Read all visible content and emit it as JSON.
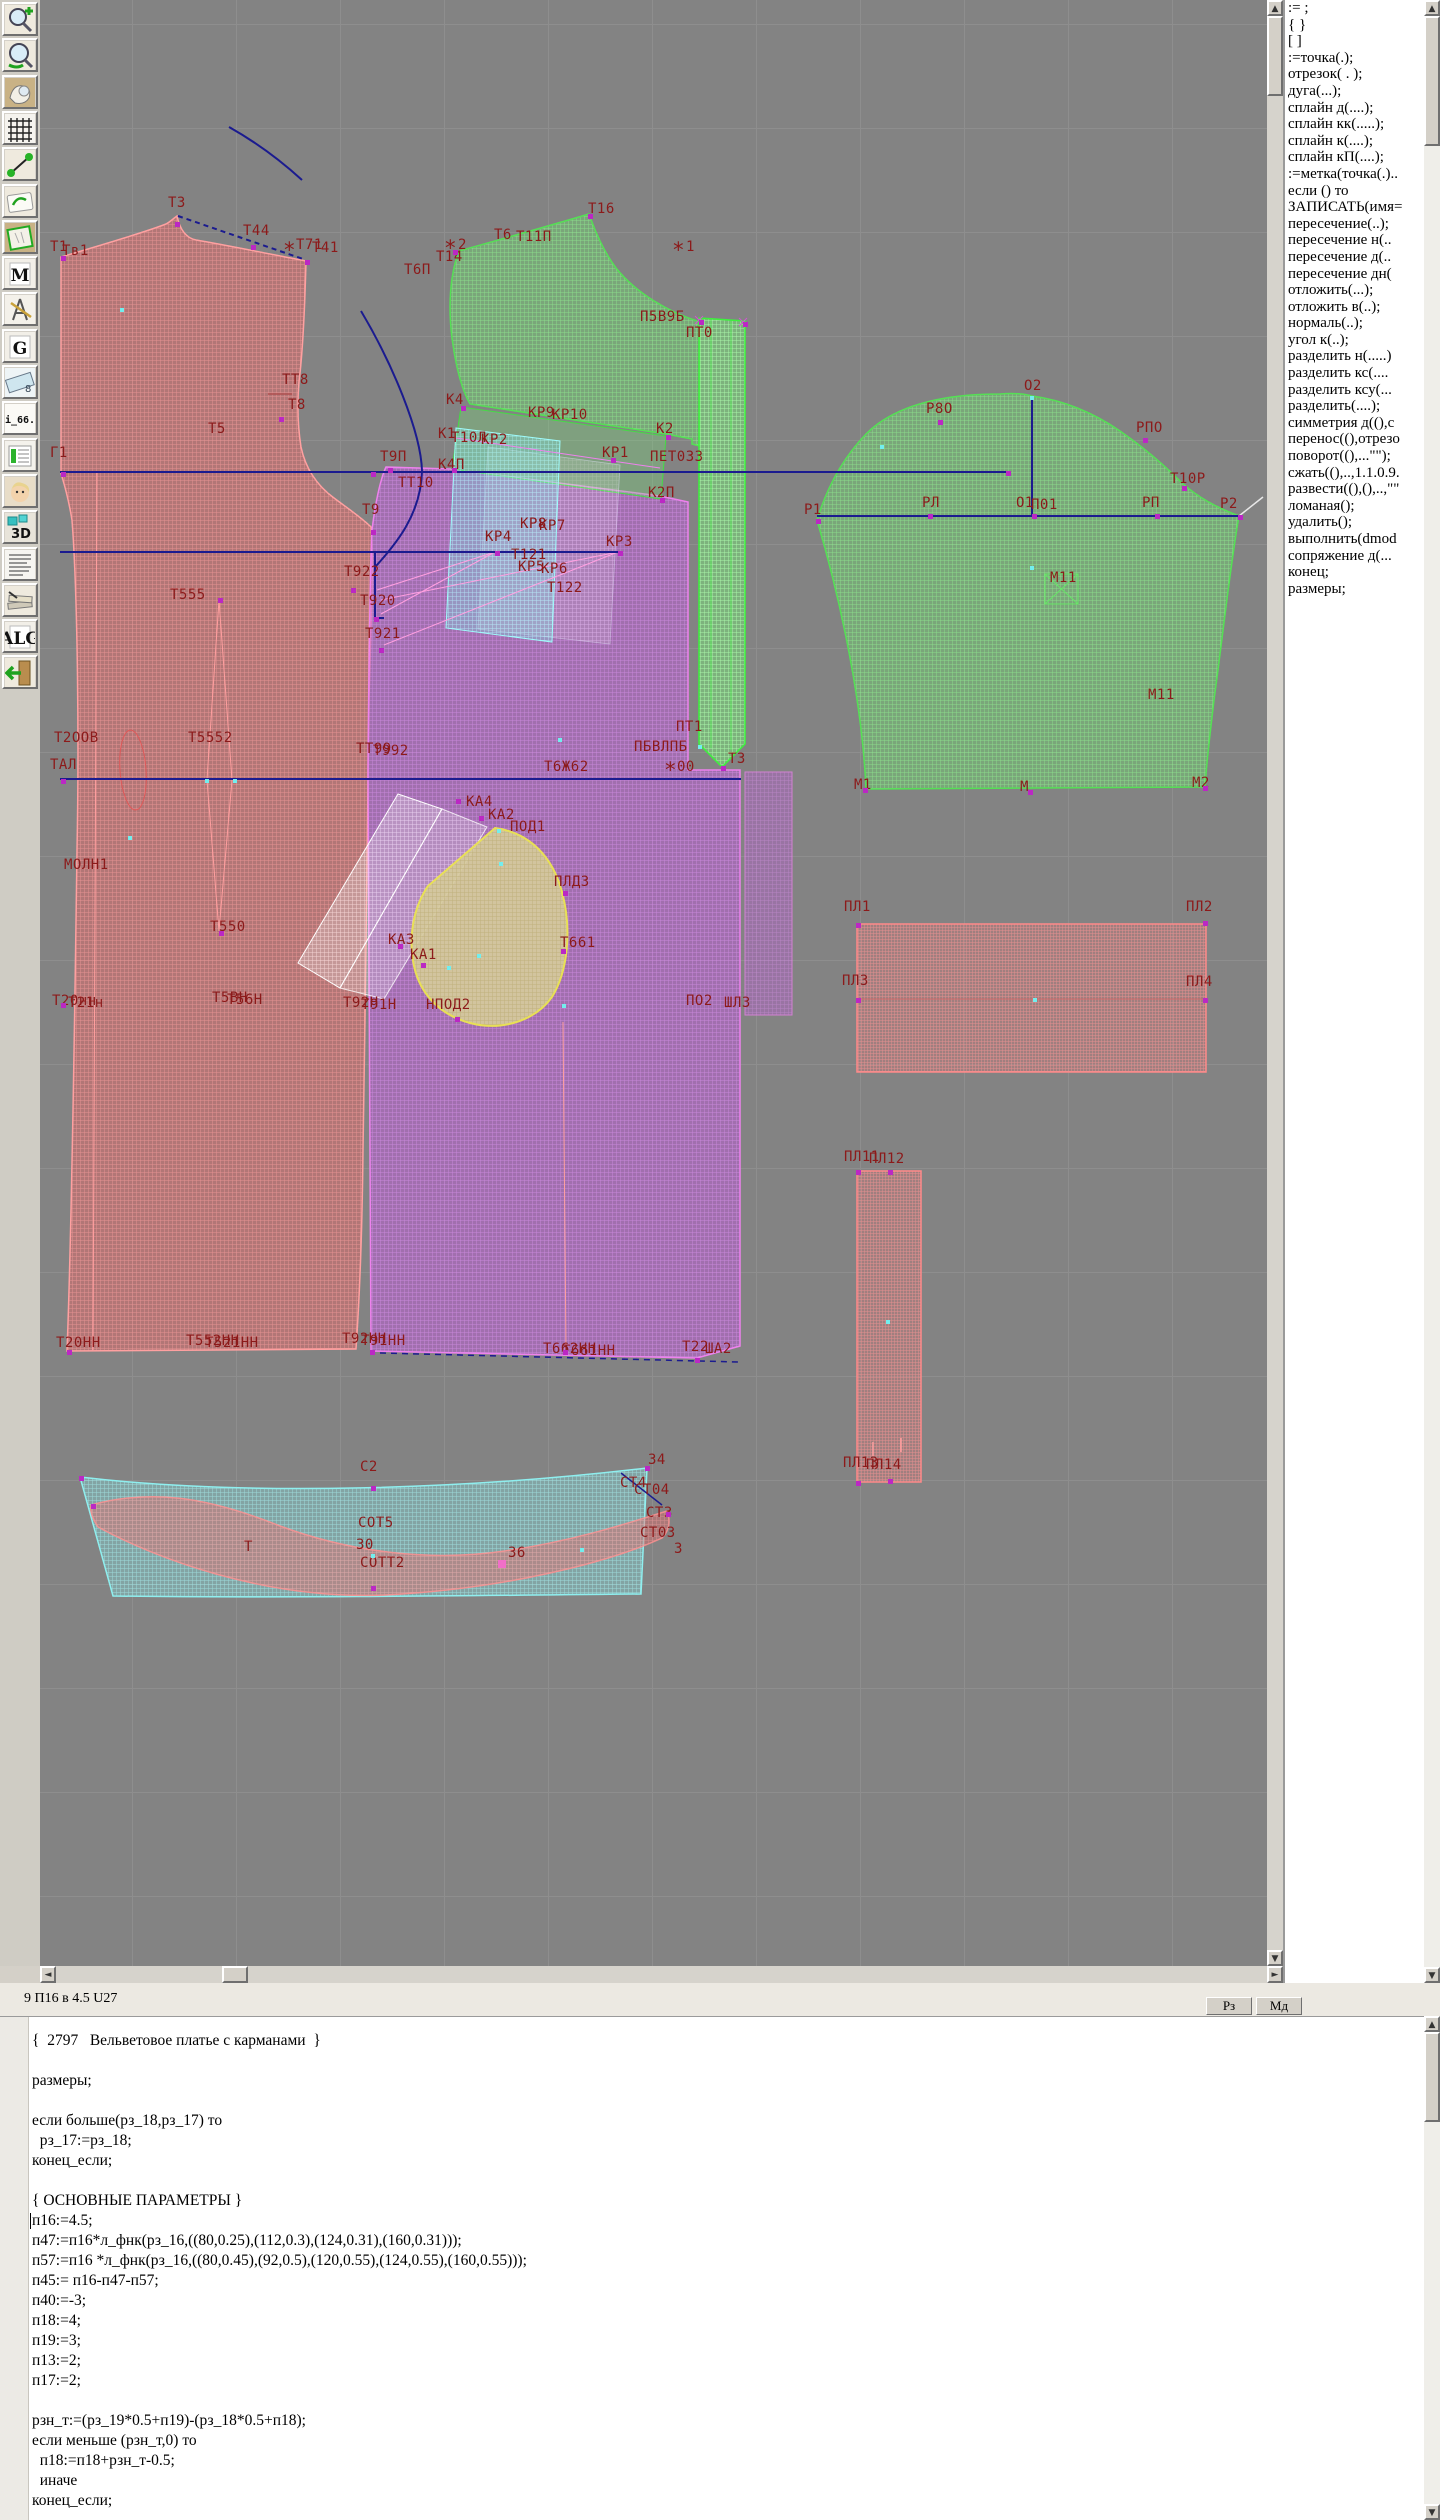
{
  "colors": {
    "canvas_bg": "#838383",
    "label": "#8c1a1a",
    "back_piece": "#e26969",
    "front_piece": "#ba5fd2",
    "sleeve": "#6ed76e",
    "pocket": "#d6cb9c",
    "belt": "#82e6e6",
    "line": "#1b1b8f"
  },
  "toolbar": {
    "icons": [
      {
        "name": "zoom-in-icon",
        "glyph": "zoomin"
      },
      {
        "name": "zoom-out-icon",
        "glyph": "zoomout"
      },
      {
        "name": "piece-view-icon",
        "glyph": "piece"
      },
      {
        "name": "grid-icon",
        "glyph": "grid"
      },
      {
        "name": "segment-icon",
        "glyph": "segment"
      },
      {
        "name": "sketch-icon",
        "glyph": "sketch"
      },
      {
        "name": "pattern-icon",
        "glyph": "pattern"
      },
      {
        "name": "measure-tool-icon",
        "glyph": "letter",
        "label": "M"
      },
      {
        "name": "compass-icon",
        "glyph": "compass"
      },
      {
        "name": "g-tool-icon",
        "glyph": "letter",
        "label": "G"
      },
      {
        "name": "ruler-icon",
        "glyph": "ruler"
      },
      {
        "name": "i66-size-icon",
        "glyph": "text",
        "label": "i_66."
      },
      {
        "name": "table-icon",
        "glyph": "table"
      },
      {
        "name": "model-photo-icon",
        "glyph": "face"
      },
      {
        "name": "3d-icon",
        "glyph": "letter3d",
        "label": "3D"
      },
      {
        "name": "text-list-icon",
        "glyph": "textlines"
      },
      {
        "name": "books-icon",
        "glyph": "books"
      },
      {
        "name": "alg-icon",
        "glyph": "letter",
        "label": "ALG"
      },
      {
        "name": "exit-icon",
        "glyph": "exit"
      }
    ]
  },
  "commands": {
    "items": [
      ":= ;",
      "{  }",
      "[  ]",
      ":=точка(.);",
      "отрезок( . );",
      "дуга(...);",
      "сплайн  д(....);",
      "сплайн  кк(.....);",
      "сплайн  к(....);",
      "сплайн  кП(....);",
      ":=метка(точка(.)..",
      "если () то",
      "ЗАПИСАТЬ(имя=",
      "пересечение(..);",
      "пересечение  н(..",
      "пересечение  д(..",
      "пересечение  дн(",
      "отложить(...);",
      "отложить  в(..);",
      "нормаль(..);",
      "угол  к(..);",
      "разделить  н(.....)",
      "разделить  кс(....",
      "разделить  ксу(...",
      "разделить(....);",
      "симметрия  д((),с",
      "перенос((),отрезо",
      "поворот((),...\"\");",
      "сжать((),..,1.1.0.9.",
      "развести((),(),..,\"\"",
      "ломаная();",
      "удалить();",
      "выполнить(dmod",
      "сопряжение  д(...",
      "конец;",
      "размеры;"
    ]
  },
  "status": {
    "left": "9  П16 в 4.5  U27",
    "btn_rz": "Рз",
    "btn_md": "Мд"
  },
  "editor": {
    "lines": [
      "{  2797   Вельветовое платье с карманами  }",
      "",
      "размеры;",
      "",
      "если больше(рз_18,рз_17) то",
      "  рз_17:=рз_18;",
      "конец_если;",
      "",
      "{ ОСНОВНЫЕ ПАРАМЕТРЫ }",
      "п16:=4.5;",
      "п47:=п16*л_фнк(рз_16,((80,0.25),(112,0.3),(124,0.31),(160,0.31)));",
      "п57:=п16 *л_фнк(рз_16,((80,0.45),(92,0.5),(120,0.55),(124,0.55),(160,0.55)));",
      "п45:= п16-п47-п57;",
      "п40:=-3;",
      "п18:=4;",
      "п19:=3;",
      "п13:=2;",
      "п17:=2;",
      "",
      "рзн_т:=(рз_19*0.5+п19)-(рз_18*0.5+п18);",
      "если меньше (рзн_т,0) то",
      "  п18:=п18+рзн_т-0.5;",
      "  иначе",
      "конец_если;"
    ]
  },
  "canvas": {
    "labels": [
      {
        "t": "Т1",
        "x": 50,
        "y": 240
      },
      {
        "t": "Тв1",
        "x": 62,
        "y": 244
      },
      {
        "t": "Т3",
        "x": 168,
        "y": 196
      },
      {
        "t": "Т44",
        "x": 243,
        "y": 224
      },
      {
        "t": "*",
        "x": 283,
        "y": 244,
        "s": 1
      },
      {
        "t": "Т71",
        "x": 296,
        "y": 238
      },
      {
        "t": "Т41",
        "x": 312,
        "y": 241
      },
      {
        "t": "*",
        "x": 444,
        "y": 242,
        "s": 1
      },
      {
        "t": "2",
        "x": 458,
        "y": 238
      },
      {
        "t": "Т14",
        "x": 436,
        "y": 250
      },
      {
        "t": "Т6П",
        "x": 404,
        "y": 263
      },
      {
        "t": "Т6",
        "x": 494,
        "y": 228
      },
      {
        "t": "Т11П",
        "x": 516,
        "y": 230
      },
      {
        "t": "Т16",
        "x": 588,
        "y": 202
      },
      {
        "t": "*",
        "x": 672,
        "y": 244,
        "s": 1
      },
      {
        "t": "1",
        "x": 686,
        "y": 240
      },
      {
        "t": "П5В9Б",
        "x": 640,
        "y": 310
      },
      {
        "t": "ПТ0",
        "x": 686,
        "y": 326
      },
      {
        "t": "ТТ8",
        "x": 282,
        "y": 373
      },
      {
        "t": "Т8",
        "x": 288,
        "y": 398
      },
      {
        "t": "Т5",
        "x": 208,
        "y": 422
      },
      {
        "t": "Г1",
        "x": 50,
        "y": 446
      },
      {
        "t": "К4",
        "x": 446,
        "y": 393
      },
      {
        "t": "КР9",
        "x": 528,
        "y": 406
      },
      {
        "t": "КР10",
        "x": 552,
        "y": 408
      },
      {
        "t": "К2",
        "x": 656,
        "y": 422
      },
      {
        "t": "К1",
        "x": 438,
        "y": 427
      },
      {
        "t": "Т10Л",
        "x": 451,
        "y": 431
      },
      {
        "t": "КР2",
        "x": 481,
        "y": 433
      },
      {
        "t": "КР1",
        "x": 602,
        "y": 446
      },
      {
        "t": "ПЕТ033",
        "x": 650,
        "y": 450
      },
      {
        "t": "Т9П",
        "x": 380,
        "y": 450
      },
      {
        "t": "ТТ10",
        "x": 398,
        "y": 476
      },
      {
        "t": "К4П",
        "x": 438,
        "y": 458
      },
      {
        "t": "К2П",
        "x": 648,
        "y": 486
      },
      {
        "t": "Т9",
        "x": 362,
        "y": 503
      },
      {
        "t": "КР8",
        "x": 520,
        "y": 517
      },
      {
        "t": "КР7",
        "x": 539,
        "y": 519
      },
      {
        "t": "КР4",
        "x": 485,
        "y": 530
      },
      {
        "t": "КР3",
        "x": 606,
        "y": 535
      },
      {
        "t": "Т121",
        "x": 511,
        "y": 548
      },
      {
        "t": "КР5",
        "x": 518,
        "y": 560
      },
      {
        "t": "КР6",
        "x": 541,
        "y": 562
      },
      {
        "t": "Т122",
        "x": 547,
        "y": 581
      },
      {
        "t": "Т922",
        "x": 344,
        "y": 565
      },
      {
        "t": "Т920",
        "x": 360,
        "y": 594
      },
      {
        "t": "Т921",
        "x": 365,
        "y": 627
      },
      {
        "t": "Т555",
        "x": 170,
        "y": 588
      },
      {
        "t": "Т2ООВ",
        "x": 54,
        "y": 731
      },
      {
        "t": "Т5552",
        "x": 188,
        "y": 731
      },
      {
        "t": "ТТ99",
        "x": 356,
        "y": 742
      },
      {
        "t": "Т992",
        "x": 373,
        "y": 744
      },
      {
        "t": "ТАЛ",
        "x": 50,
        "y": 758
      },
      {
        "t": "МОЛН1",
        "x": 64,
        "y": 858
      },
      {
        "t": "Т550",
        "x": 210,
        "y": 920
      },
      {
        "t": "Т6Ж62",
        "x": 544,
        "y": 760
      },
      {
        "t": "*",
        "x": 664,
        "y": 764,
        "s": 1
      },
      {
        "t": "00",
        "x": 677,
        "y": 760
      },
      {
        "t": "ПТ1",
        "x": 676,
        "y": 720
      },
      {
        "t": "ПБВЛПБ",
        "x": 634,
        "y": 740
      },
      {
        "t": "Т3",
        "x": 728,
        "y": 752
      },
      {
        "t": "КА4",
        "x": 466,
        "y": 795
      },
      {
        "t": "КА2",
        "x": 488,
        "y": 808
      },
      {
        "t": "ПОД1",
        "x": 510,
        "y": 820
      },
      {
        "t": "ПЛД3",
        "x": 554,
        "y": 875
      },
      {
        "t": "КА3",
        "x": 388,
        "y": 933
      },
      {
        "t": "КА1",
        "x": 410,
        "y": 948
      },
      {
        "t": "Т661",
        "x": 560,
        "y": 936
      },
      {
        "t": "Т20нн",
        "x": 52,
        "y": 994
      },
      {
        "t": "Т21н",
        "x": 68,
        "y": 996
      },
      {
        "t": "Т5ВН",
        "x": 212,
        "y": 991
      },
      {
        "t": "Т56Н",
        "x": 227,
        "y": 993
      },
      {
        "t": "Т92Н",
        "x": 343,
        "y": 996
      },
      {
        "t": "Т91Н",
        "x": 361,
        "y": 998
      },
      {
        "t": "НПОД2",
        "x": 426,
        "y": 998
      },
      {
        "t": "ПО2",
        "x": 686,
        "y": 994
      },
      {
        "t": "ШЛ3",
        "x": 724,
        "y": 996
      },
      {
        "t": "Т20НН",
        "x": 56,
        "y": 1336
      },
      {
        "t": "Т552НН",
        "x": 186,
        "y": 1334
      },
      {
        "t": "Т521НН",
        "x": 205,
        "y": 1336
      },
      {
        "t": "Т92НН",
        "x": 342,
        "y": 1332
      },
      {
        "t": "Т91НН",
        "x": 361,
        "y": 1334
      },
      {
        "t": "Т662НН",
        "x": 543,
        "y": 1342
      },
      {
        "t": "Т661НН",
        "x": 562,
        "y": 1344
      },
      {
        "t": "Т22",
        "x": 682,
        "y": 1340
      },
      {
        "t": "ША2",
        "x": 705,
        "y": 1342
      },
      {
        "t": "О2",
        "x": 1024,
        "y": 379
      },
      {
        "t": "Р8О",
        "x": 926,
        "y": 402
      },
      {
        "t": "РПО",
        "x": 1136,
        "y": 421
      },
      {
        "t": "Т10Р",
        "x": 1170,
        "y": 472
      },
      {
        "t": "Р1",
        "x": 804,
        "y": 503
      },
      {
        "t": "РЛ",
        "x": 922,
        "y": 496
      },
      {
        "t": "О1",
        "x": 1016,
        "y": 496
      },
      {
        "t": "П01",
        "x": 1031,
        "y": 498
      },
      {
        "t": "РП",
        "x": 1142,
        "y": 496
      },
      {
        "t": "Р2",
        "x": 1220,
        "y": 497
      },
      {
        "t": "М11",
        "x": 1050,
        "y": 571
      },
      {
        "t": "М11",
        "x": 1148,
        "y": 688
      },
      {
        "t": "М1",
        "x": 854,
        "y": 778
      },
      {
        "t": "М",
        "x": 1020,
        "y": 780
      },
      {
        "t": "М2",
        "x": 1192,
        "y": 776
      },
      {
        "t": "ПЛ1",
        "x": 844,
        "y": 900
      },
      {
        "t": "ПЛ2",
        "x": 1186,
        "y": 900
      },
      {
        "t": "ПЛ3",
        "x": 842,
        "y": 974
      },
      {
        "t": "ПЛ4",
        "x": 1186,
        "y": 975
      },
      {
        "t": "ПЛ11",
        "x": 844,
        "y": 1150
      },
      {
        "t": "ПЛ12",
        "x": 869,
        "y": 1152
      },
      {
        "t": "ПЛ13",
        "x": 843,
        "y": 1456
      },
      {
        "t": "ПЛ14",
        "x": 866,
        "y": 1458
      },
      {
        "t": "С2",
        "x": 360,
        "y": 1460
      },
      {
        "t": "34",
        "x": 648,
        "y": 1453
      },
      {
        "t": "СТ4",
        "x": 620,
        "y": 1476
      },
      {
        "t": "СТ04",
        "x": 634,
        "y": 1483
      },
      {
        "t": "СТ3",
        "x": 646,
        "y": 1506
      },
      {
        "t": "СТ03",
        "x": 640,
        "y": 1526
      },
      {
        "t": "СОТ5",
        "x": 358,
        "y": 1516
      },
      {
        "t": "30",
        "x": 356,
        "y": 1538
      },
      {
        "t": "СОТТ2",
        "x": 360,
        "y": 1556
      },
      {
        "t": "36",
        "x": 508,
        "y": 1546
      },
      {
        "t": "3",
        "x": 674,
        "y": 1542
      },
      {
        "t": "Т",
        "x": 244,
        "y": 1540
      }
    ],
    "points": [
      {
        "x": 61,
        "y": 256,
        "c": "m"
      },
      {
        "x": 175,
        "y": 222,
        "c": "m"
      },
      {
        "x": 251,
        "y": 245,
        "c": "m"
      },
      {
        "x": 305,
        "y": 260,
        "c": "m"
      },
      {
        "x": 120,
        "y": 308,
        "c": "c"
      },
      {
        "x": 61,
        "y": 472,
        "c": "m"
      },
      {
        "x": 279,
        "y": 417,
        "c": "m"
      },
      {
        "x": 61,
        "y": 779,
        "c": "m"
      },
      {
        "x": 205,
        "y": 779,
        "c": "c"
      },
      {
        "x": 233,
        "y": 779,
        "c": "c"
      },
      {
        "x": 218,
        "y": 598,
        "c": "m"
      },
      {
        "x": 219,
        "y": 931,
        "c": "m"
      },
      {
        "x": 61,
        "y": 1003,
        "c": "m"
      },
      {
        "x": 67,
        "y": 1350,
        "c": "m"
      },
      {
        "x": 351,
        "y": 588,
        "c": "m"
      },
      {
        "x": 374,
        "y": 617,
        "c": "m"
      },
      {
        "x": 379,
        "y": 648,
        "c": "m"
      },
      {
        "x": 371,
        "y": 530,
        "c": "m"
      },
      {
        "x": 388,
        "y": 468,
        "c": "m"
      },
      {
        "x": 452,
        "y": 468,
        "c": "m"
      },
      {
        "x": 461,
        "y": 406,
        "c": "m"
      },
      {
        "x": 666,
        "y": 435,
        "c": "m"
      },
      {
        "x": 660,
        "y": 498,
        "c": "m"
      },
      {
        "x": 611,
        "y": 458,
        "c": "m"
      },
      {
        "x": 495,
        "y": 551,
        "c": "m"
      },
      {
        "x": 618,
        "y": 551,
        "c": "m"
      },
      {
        "x": 371,
        "y": 472,
        "c": "m"
      },
      {
        "x": 453,
        "y": 250,
        "c": "m"
      },
      {
        "x": 588,
        "y": 214,
        "c": "m"
      },
      {
        "x": 699,
        "y": 320,
        "c": "m"
      },
      {
        "x": 743,
        "y": 322,
        "c": "m"
      },
      {
        "x": 721,
        "y": 766,
        "c": "m"
      },
      {
        "x": 698,
        "y": 745,
        "c": "c"
      },
      {
        "x": 497,
        "y": 829,
        "c": "c"
      },
      {
        "x": 563,
        "y": 891,
        "c": "m"
      },
      {
        "x": 561,
        "y": 949,
        "c": "m"
      },
      {
        "x": 562,
        "y": 1004,
        "c": "c"
      },
      {
        "x": 455,
        "y": 1017,
        "c": "m"
      },
      {
        "x": 421,
        "y": 963,
        "c": "m"
      },
      {
        "x": 398,
        "y": 944,
        "c": "m"
      },
      {
        "x": 477,
        "y": 954,
        "c": "c"
      },
      {
        "x": 447,
        "y": 966,
        "c": "c"
      },
      {
        "x": 499,
        "y": 862,
        "c": "c"
      },
      {
        "x": 456,
        "y": 799,
        "c": "m"
      },
      {
        "x": 479,
        "y": 816,
        "c": "m"
      },
      {
        "x": 695,
        "y": 1358,
        "c": "m"
      },
      {
        "x": 370,
        "y": 1350,
        "c": "m"
      },
      {
        "x": 563,
        "y": 1350,
        "c": "m"
      },
      {
        "x": 816,
        "y": 519,
        "c": "m"
      },
      {
        "x": 1030,
        "y": 396,
        "c": "c"
      },
      {
        "x": 1238,
        "y": 515,
        "c": "m"
      },
      {
        "x": 863,
        "y": 788,
        "c": "m"
      },
      {
        "x": 1028,
        "y": 790,
        "c": "m"
      },
      {
        "x": 1203,
        "y": 786,
        "c": "m"
      },
      {
        "x": 1030,
        "y": 566,
        "c": "c"
      },
      {
        "x": 938,
        "y": 420,
        "c": "m"
      },
      {
        "x": 1143,
        "y": 438,
        "c": "m"
      },
      {
        "x": 1182,
        "y": 486,
        "c": "m"
      },
      {
        "x": 928,
        "y": 514,
        "c": "m"
      },
      {
        "x": 1155,
        "y": 514,
        "c": "m"
      },
      {
        "x": 1032,
        "y": 514,
        "c": "m"
      },
      {
        "x": 1006,
        "y": 471,
        "c": "m"
      },
      {
        "x": 880,
        "y": 445,
        "c": "c"
      },
      {
        "x": 856,
        "y": 923,
        "c": "m"
      },
      {
        "x": 1203,
        "y": 921,
        "c": "m"
      },
      {
        "x": 856,
        "y": 998,
        "c": "m"
      },
      {
        "x": 1203,
        "y": 998,
        "c": "m"
      },
      {
        "x": 1033,
        "y": 998,
        "c": "c"
      },
      {
        "x": 856,
        "y": 1170,
        "c": "m"
      },
      {
        "x": 888,
        "y": 1170,
        "c": "m"
      },
      {
        "x": 856,
        "y": 1481,
        "c": "m"
      },
      {
        "x": 888,
        "y": 1479,
        "c": "m"
      },
      {
        "x": 886,
        "y": 1320,
        "c": "c"
      },
      {
        "x": 371,
        "y": 1486,
        "c": "m"
      },
      {
        "x": 79,
        "y": 1476,
        "c": "m"
      },
      {
        "x": 645,
        "y": 1466,
        "c": "m"
      },
      {
        "x": 91,
        "y": 1504,
        "c": "m"
      },
      {
        "x": 666,
        "y": 1512,
        "c": "m"
      },
      {
        "x": 371,
        "y": 1554,
        "c": "c"
      },
      {
        "x": 498,
        "y": 1560,
        "c": "p"
      },
      {
        "x": 371,
        "y": 1586,
        "c": "m"
      },
      {
        "x": 580,
        "y": 1548,
        "c": "c"
      },
      {
        "x": 558,
        "y": 738,
        "c": "c"
      },
      {
        "x": 128,
        "y": 836,
        "c": "c"
      }
    ]
  }
}
